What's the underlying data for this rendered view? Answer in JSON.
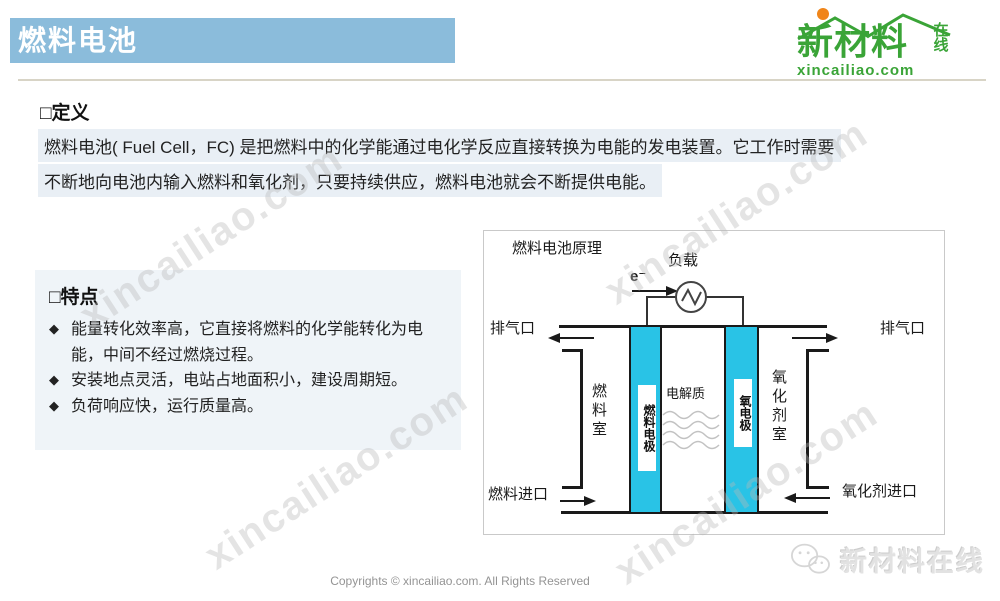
{
  "page": {
    "title": "燃料电池"
  },
  "logo_top": {
    "name": "新材料",
    "suffix": "在线",
    "domain": "xincailiao.com"
  },
  "definition": {
    "heading": "□定义",
    "line1": "燃料电池( Fuel Cell，FC) 是把燃料中的化学能通过电化学反应直接转换为电能的发电装置。它工作时需要",
    "line2": "不断地向电池内输入燃料和氧化剂，只要持续供应，燃料电池就会不断提供电能。"
  },
  "features": {
    "heading": "□特点",
    "bullet_glyph": "◆",
    "items": [
      "能量转化效率高，它直接将燃料的化学能转化为电能，中间不经过燃烧过程。",
      "安装地点灵活，电站占地面积小，建设周期短。",
      "负荷响应快，运行质量高。"
    ]
  },
  "diagram": {
    "title": "燃料电池原理",
    "electrode_color": "#29c3e6",
    "labels": {
      "load": "负载",
      "electron": "e⁻",
      "exhaust_left": "排气口",
      "exhaust_right": "排气口",
      "fuel_chamber": "燃料室",
      "fuel_electrode": "燃料电极",
      "electrolyte": "电解质",
      "oxygen_electrode": "氧电极",
      "oxidant_chamber": "氧化剂室",
      "fuel_inlet": "燃料进口",
      "oxidant_inlet": "氧化剂进口"
    }
  },
  "watermark": {
    "text": "xincailiao.com"
  },
  "footer": {
    "copyright": "Copyrights © xincailiao.com. All Rights Reserved",
    "ghost_logo_text": "新材料在线"
  }
}
